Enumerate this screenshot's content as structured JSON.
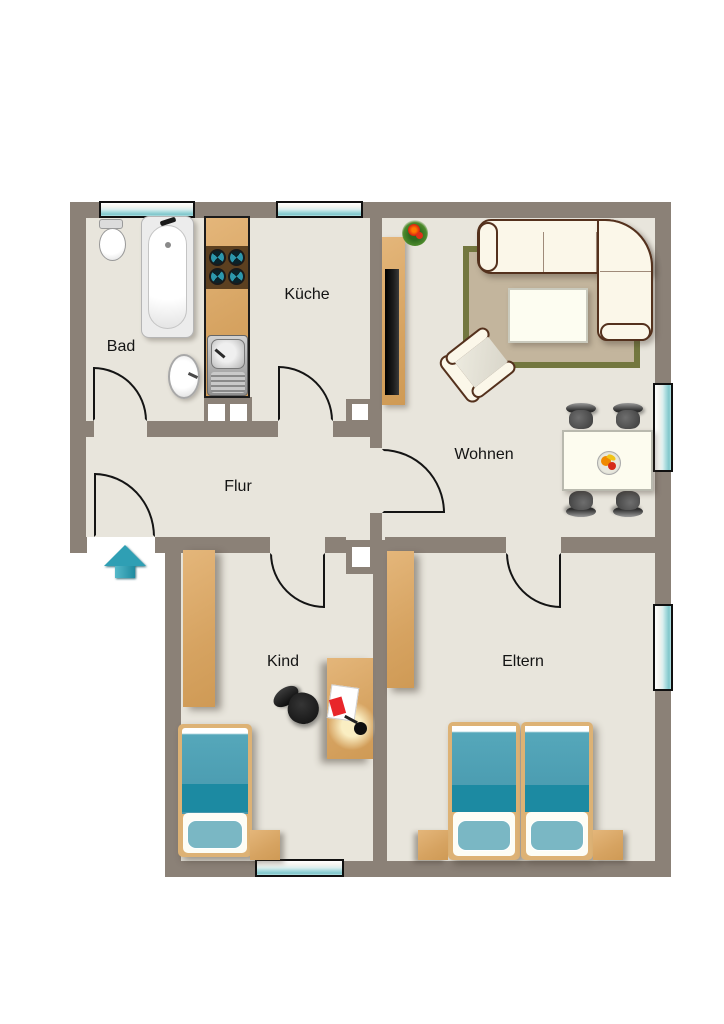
{
  "plan": {
    "title": "Apartment floor plan",
    "rooms": [
      {
        "id": "bad",
        "label": "Bad"
      },
      {
        "id": "kueche",
        "label": "Küche"
      },
      {
        "id": "flur",
        "label": "Flur"
      },
      {
        "id": "wohnen",
        "label": "Wohnen"
      },
      {
        "id": "kind",
        "label": "Kind"
      },
      {
        "id": "eltern",
        "label": "Eltern"
      }
    ],
    "window_count": 5,
    "door_count": 6,
    "colors": {
      "wall": "#8b8177",
      "floor": "#e8e5dc",
      "wood": "#d6a361",
      "window_glass": "#8fd0d4",
      "textile_teal": "#4798ad",
      "textile_dark_teal": "#1c8aa2",
      "sofa_cream": "#fbf7e9",
      "entrance_arrow": "#2f9fb4"
    }
  }
}
